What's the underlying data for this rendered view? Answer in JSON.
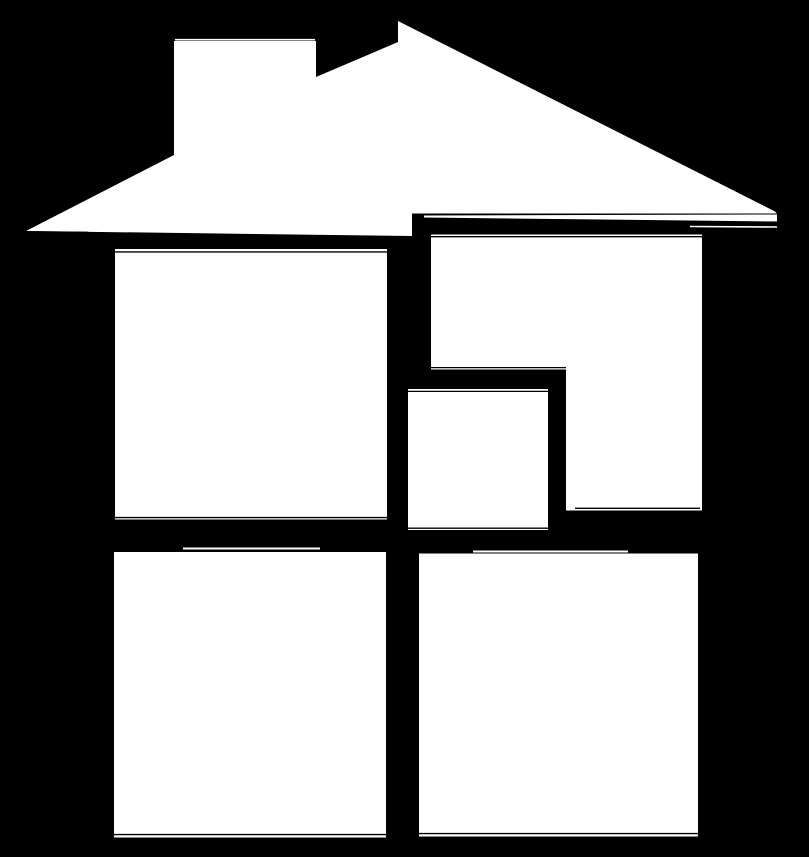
{
  "canvas": {
    "width": 809,
    "height": 857,
    "background": "#000000",
    "foreground": "#ffffff"
  },
  "logo": {
    "title": "White house silhouette logo: peaked roof with chimney above five window panes on a black background",
    "shapes": [
      {
        "name": "roof-and-chimney",
        "type": "polygon",
        "points": [
          [
            398,
            21
          ],
          [
            775,
            211.5
          ],
          [
            777,
            213.5
          ],
          [
            412,
            213.5
          ],
          [
            412,
            236
          ],
          [
            26,
            231
          ],
          [
            174,
            155
          ],
          [
            174,
            41
          ],
          [
            316,
            41
          ],
          [
            316,
            77
          ],
          [
            398,
            42
          ]
        ]
      },
      {
        "name": "roof-eave-strip",
        "type": "polygon",
        "points": [
          [
            424,
            215.5
          ],
          [
            777,
            214.5
          ],
          [
            777,
            221.5
          ],
          [
            424,
            217.5
          ]
        ]
      },
      {
        "name": "window-top-left",
        "type": "rect",
        "x": 115,
        "y": 249,
        "w": 272,
        "h": 270.5
      },
      {
        "name": "window-top-right",
        "type": "polygon",
        "points": [
          [
            431,
            234.5
          ],
          [
            702,
            234.5
          ],
          [
            702,
            510.5
          ],
          [
            566,
            510.5
          ],
          [
            566,
            369.5
          ],
          [
            431,
            369.5
          ]
        ]
      },
      {
        "name": "window-center",
        "type": "rect",
        "x": 408,
        "y": 389,
        "w": 140,
        "h": 141
      },
      {
        "name": "window-bottom-left",
        "type": "rect",
        "x": 114,
        "y": 552,
        "w": 272,
        "h": 285.5
      },
      {
        "name": "window-bottom-right",
        "type": "rect",
        "x": 419,
        "y": 553.5,
        "w": 279,
        "h": 283
      }
    ],
    "hairlines": [
      {
        "name": "chimney-top-hairline",
        "color": "#ffffff",
        "x1": 175,
        "y1": 39.7,
        "x2": 315,
        "y2": 39.7,
        "w": 1.6
      },
      {
        "name": "eave-left-hairline",
        "color": "#000000",
        "x1": 27,
        "y1": 231.8,
        "x2": 88,
        "y2": 232.3,
        "w": 1.4
      },
      {
        "name": "eave-right-under-hairline",
        "color": "#ffffff",
        "x1": 690,
        "y1": 226.5,
        "x2": 777,
        "y2": 227,
        "w": 1.6
      },
      {
        "name": "window-top-left-top-hairline",
        "color": "#000000",
        "x1": 115,
        "y1": 251.9,
        "x2": 387,
        "y2": 251.9,
        "w": 1.4
      },
      {
        "name": "window-top-left-bottom-hairline",
        "color": "#000000",
        "x1": 115,
        "y1": 517.6,
        "x2": 387,
        "y2": 517.6,
        "w": 1.4
      },
      {
        "name": "window-top-right-top-hairline",
        "color": "#000000",
        "x1": 431,
        "y1": 236.7,
        "x2": 702,
        "y2": 236.7,
        "w": 1.3
      },
      {
        "name": "window-top-right-mid-hairline",
        "color": "#000000",
        "x1": 431,
        "y1": 367.6,
        "x2": 566,
        "y2": 367.6,
        "w": 1.3
      },
      {
        "name": "window-top-right-column-bottom-hairline",
        "color": "#000000",
        "x1": 575,
        "y1": 508.3,
        "x2": 700,
        "y2": 508.3,
        "w": 1.4
      },
      {
        "name": "window-center-top-hairline",
        "color": "#000000",
        "x1": 408,
        "y1": 391.4,
        "x2": 548,
        "y2": 391.4,
        "w": 1.3
      },
      {
        "name": "window-center-bottom-hairline",
        "color": "#000000",
        "x1": 408,
        "y1": 528.2,
        "x2": 548,
        "y2": 528.2,
        "w": 1.3
      },
      {
        "name": "window-bottom-left-top-hairline",
        "color": "#ffffff",
        "x1": 183,
        "y1": 548.5,
        "x2": 320,
        "y2": 548.5,
        "w": 2
      },
      {
        "name": "window-bottom-left-bottom-hairline",
        "color": "#000000",
        "x1": 114,
        "y1": 834.6,
        "x2": 386,
        "y2": 834.6,
        "w": 1.4
      },
      {
        "name": "window-bottom-right-top-hairline",
        "color": "#ffffff",
        "x1": 473,
        "y1": 551.5,
        "x2": 628,
        "y2": 551.5,
        "w": 2
      },
      {
        "name": "window-bottom-right-bottom-hairline",
        "color": "#000000",
        "x1": 419,
        "y1": 833.6,
        "x2": 698,
        "y2": 833.6,
        "w": 1.4
      }
    ]
  }
}
